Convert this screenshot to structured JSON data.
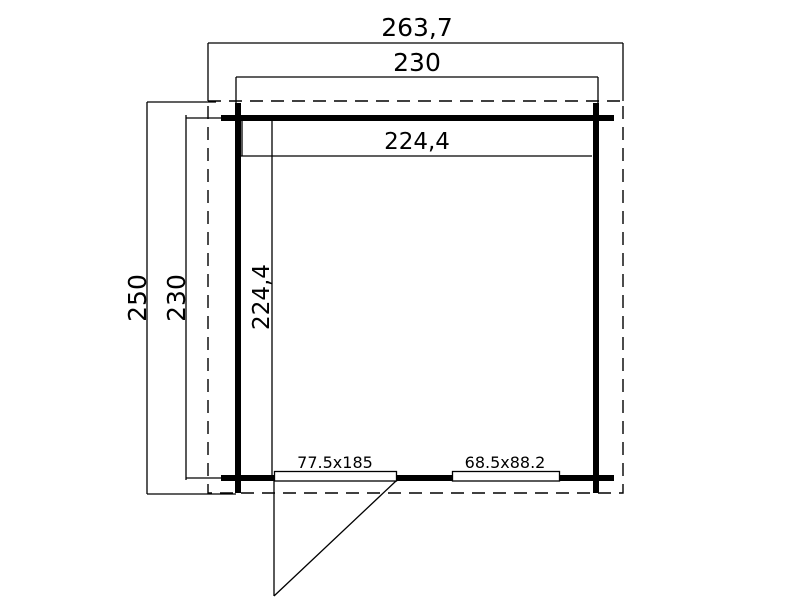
{
  "canvas": {
    "background": "#ffffff",
    "line_color": "#000000",
    "drawing_type": "floor-plan"
  },
  "floor_plan": {
    "dims": {
      "roof_width": "263,7",
      "outer_width": "230",
      "inner_width": "224,4",
      "roof_depth": "250",
      "outer_depth": "230",
      "inner_depth": "224,4"
    },
    "openings": {
      "door_size": "77.5x185",
      "window_size": "68.5x88.2"
    }
  }
}
